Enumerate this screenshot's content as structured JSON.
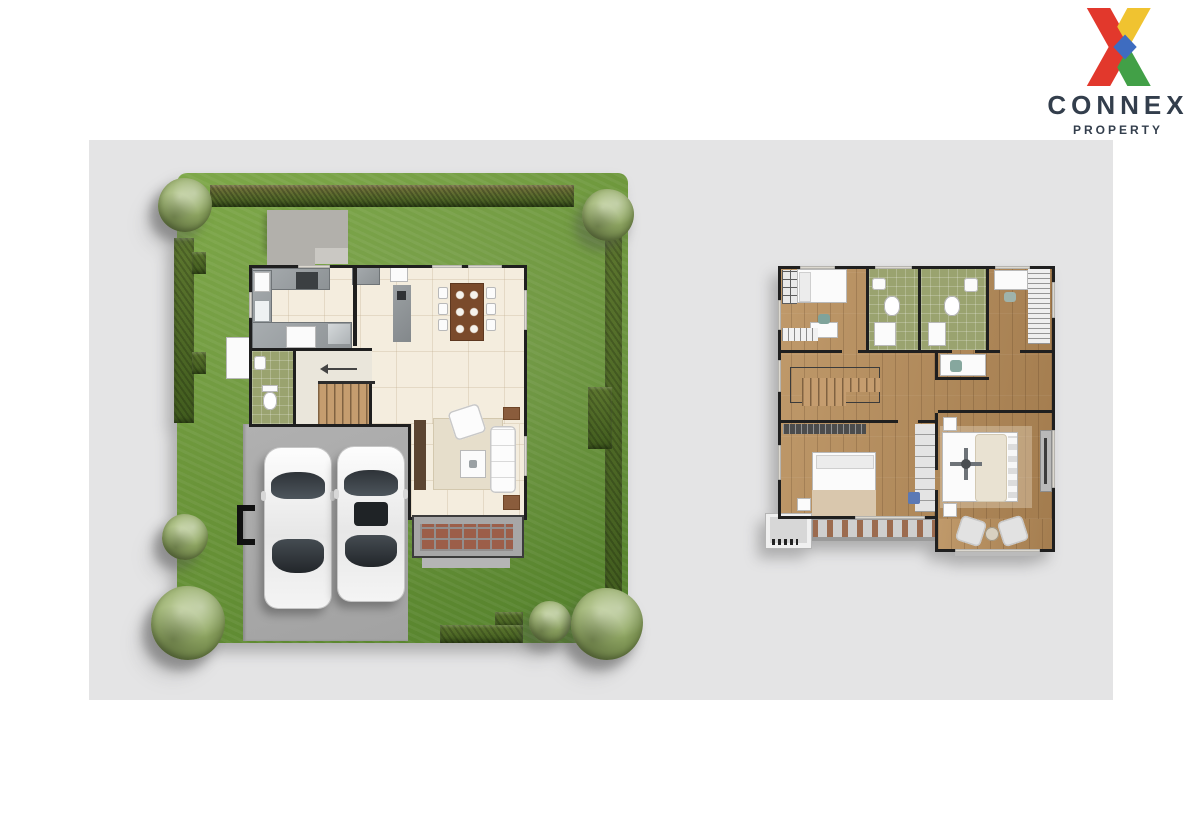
{
  "logo": {
    "brand": "CONNEX",
    "tagline": "PROPERTY",
    "text_color": "#333e4c",
    "x_colors": {
      "red": "#e2382c",
      "yellow": "#f0c330",
      "green": "#42a047",
      "blue": "#3e6cc0"
    }
  },
  "canvas": {
    "page_background": "#ffffff",
    "panel_background": "#e4e4e5"
  },
  "floor_plans": {
    "first_floor": {
      "name": "first-floor-site-plan",
      "rooms": [
        "kitchen",
        "dining area",
        "bathroom",
        "stair hall",
        "living room",
        "terrace deck",
        "garage driveway"
      ],
      "site_features": [
        "lawn",
        "perimeter hedges",
        "six trees",
        "entry porch",
        "gate",
        "two parked cars"
      ],
      "palette": {
        "lawn": "#6a9439",
        "hedge": "#48641f",
        "driveway": "#a9a9a9",
        "interior_floor": "#f4edde",
        "terrace_tiles": "#9c5e49",
        "walls": "#1f1f1f"
      }
    },
    "second_floor": {
      "name": "second-floor-plan",
      "rooms": [
        "bedroom 1",
        "bedroom 2",
        "bedroom 3",
        "master bedroom",
        "bathroom 1",
        "bathroom 2",
        "staircase",
        "hallway closet",
        "balcony",
        "sitting corner"
      ],
      "palette": {
        "wood_floor": "#b48a5f",
        "bathroom_floor": "#9aa36f",
        "walls": "#1f1f1f"
      }
    }
  }
}
